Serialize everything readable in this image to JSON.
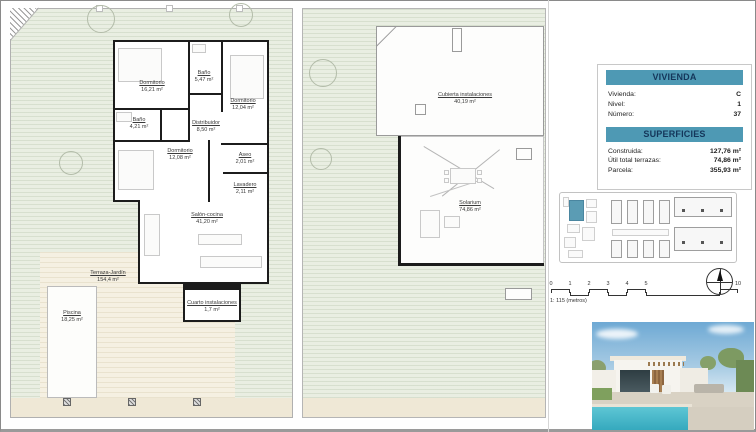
{
  "info_panel": {
    "vivienda": {
      "header": "VIVIENDA",
      "rows": [
        {
          "label": "Vivienda:",
          "value": "C"
        },
        {
          "label": "Nivel:",
          "value": "1"
        },
        {
          "label": "Número:",
          "value": "37"
        }
      ]
    },
    "superficies": {
      "header": "SUPERFICIES",
      "rows": [
        {
          "label": "Construida:",
          "value": "127,76 m²"
        },
        {
          "label": "Útil total terrazas:",
          "value": "74,86 m²"
        },
        {
          "label": "Parcela:",
          "value": "355,93 m²"
        }
      ]
    },
    "accent_color": "#4e99b4",
    "text_color": "#14365a"
  },
  "plan_ground": {
    "rooms": [
      {
        "name": "Dormitorio",
        "area": "16,21 m²"
      },
      {
        "name": "Baño",
        "area": "5,47 m²"
      },
      {
        "name": "Dormitorio",
        "area": "12,04 m²"
      },
      {
        "name": "Baño",
        "area": "4,21 m²"
      },
      {
        "name": "Distribuidor",
        "area": "8,50 m²"
      },
      {
        "name": "Dormitorio",
        "area": "12,08 m²"
      },
      {
        "name": "Aseo",
        "area": "2,01 m²"
      },
      {
        "name": "Lavadero",
        "area": "2,11 m²"
      },
      {
        "name": "Salón-cocina",
        "area": "41,20 m²"
      },
      {
        "name": "Terraza-Jardín",
        "area": "154,4 m²"
      },
      {
        "name": "Piscina",
        "area": "18,25 m²"
      },
      {
        "name": "Cuarto instalaciones",
        "area": "1,7 m²"
      }
    ]
  },
  "plan_roof": {
    "rooms": [
      {
        "name": "Cubierta instalaciones",
        "area": "40,19 m²"
      },
      {
        "name": "Solarium",
        "area": "74,86 m²"
      }
    ]
  },
  "site_plan": {
    "highlight_color": "#5b9cb4"
  },
  "scale_bar": {
    "ticks": [
      "0",
      "1",
      "2",
      "3",
      "4",
      "5",
      "10"
    ],
    "label": "1: 115 (metros)"
  }
}
